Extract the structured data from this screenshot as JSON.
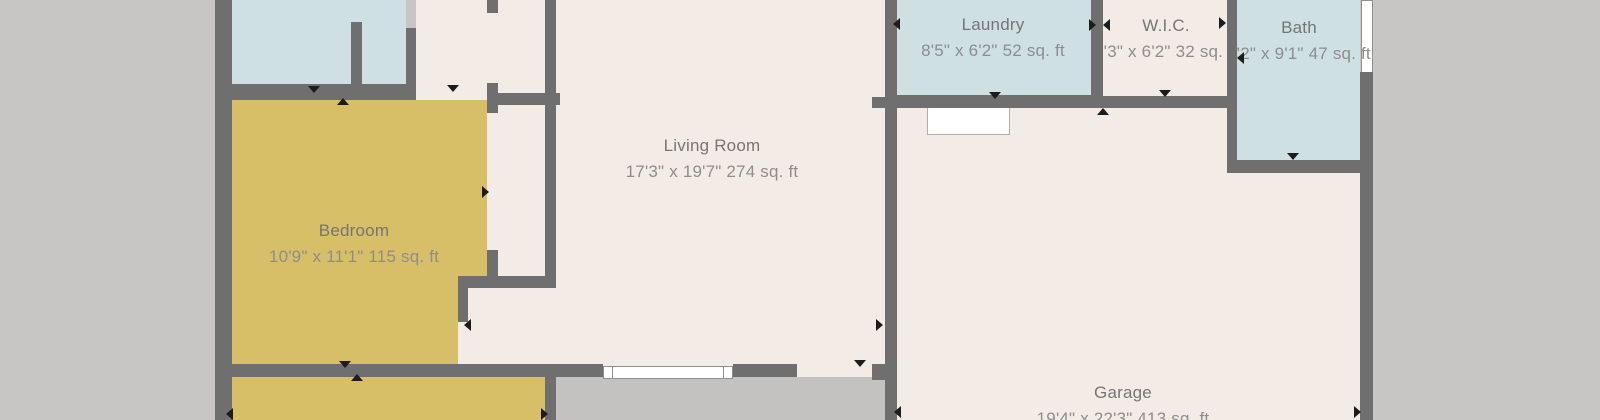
{
  "plan": {
    "rooms": {
      "top_left": {
        "name": "",
        "dims": "7'9\" x 7'10\" 58 sq. ft"
      },
      "laundry": {
        "name": "Laundry",
        "dims": "8'5\" x 6'2\" 52 sq. ft"
      },
      "wic": {
        "name": "W.I.C.",
        "dims": "5'3\" x 6'2\" 32 sq. ft"
      },
      "bath": {
        "name": "Bath",
        "dims": "5'2\" x 9'1\" 47 sq. ft"
      },
      "living_room": {
        "name": "Living Room",
        "dims": "17'3\" x 19'7\" 274 sq. ft"
      },
      "bedroom": {
        "name": "Bedroom",
        "dims": "10'9\" x 11'1\" 115 sq. ft"
      },
      "garage": {
        "name": "Garage",
        "dims": "19'4\" x 22'3\" 413 sq. ft"
      }
    },
    "colors": {
      "background": "#c7c6c4",
      "wall": "#6f6f6f",
      "floor_main": "#f3ece6",
      "floor_wet": "#cfe0e3",
      "floor_bedroom": "#d7bf67",
      "porch": "#c3c2c0",
      "window": "#ffffff",
      "room_name_text": "#757575",
      "room_dims_text": "#8d8d8d",
      "door_marker": "#1c1c1c"
    }
  }
}
